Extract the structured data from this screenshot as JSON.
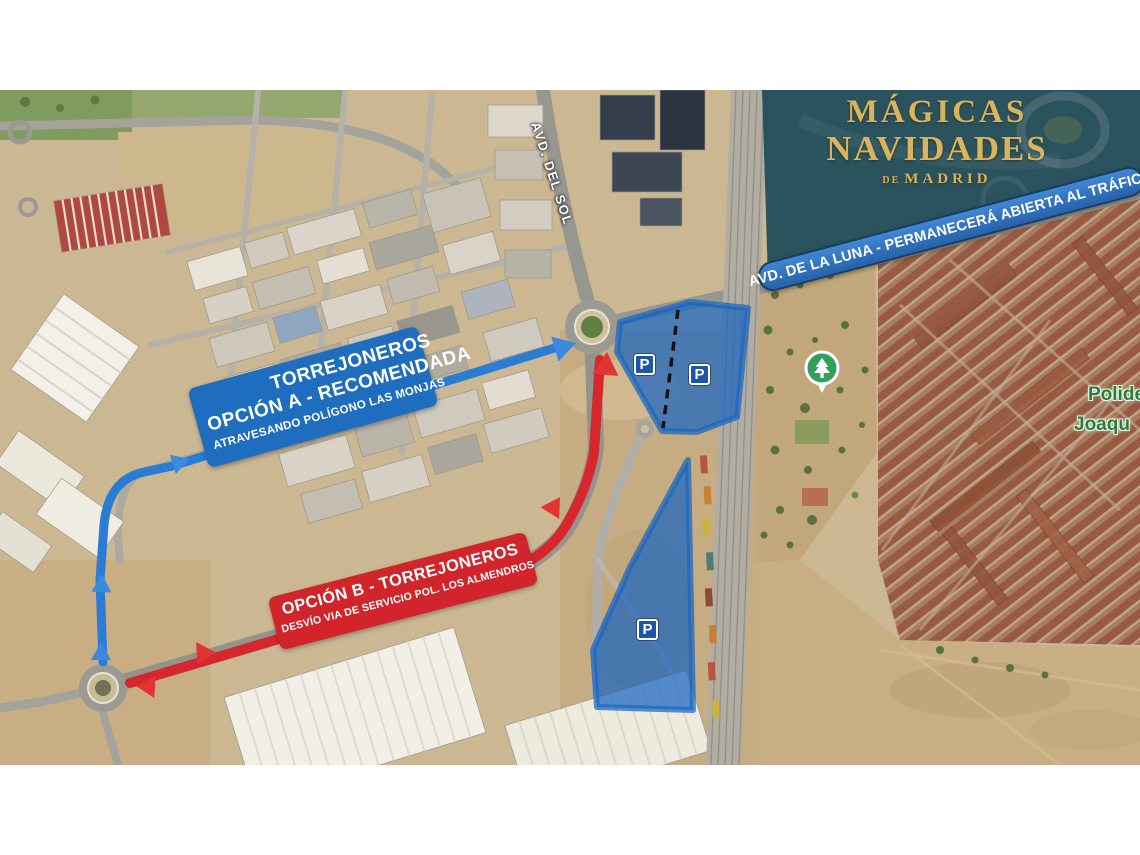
{
  "logo": {
    "title_line1": "MÁGICAS",
    "title_line2": "NAVIDADES",
    "subtitle_de": "DE",
    "subtitle_madrid": "MADRID"
  },
  "overlay_banner": {
    "text": "AVD. DE LA LUNA - PERMANECERÁ ABIERTA AL TRÁFICO"
  },
  "route_option_a": {
    "line1": "TORREJONEROS",
    "line2": "OPCIÓN A -  RECOMENDADA",
    "line3": "ATRAVESANDO POLÍGONO LAS MONJAS"
  },
  "route_option_b": {
    "line1": "OPCIÓN B - TORREJONEROS",
    "line2": "DESVÍO VIA DE SERVICIO POL. LOS ALMENDROS"
  },
  "street_labels": {
    "avd_del_sol": "AVD. DEL SOL"
  },
  "map_labels": {
    "place_line1": "Polide",
    "place_line2": "Joaqu"
  },
  "parking_badges": [
    {
      "letter": "P"
    },
    {
      "letter": "P"
    },
    {
      "letter": "P"
    }
  ],
  "colors": {
    "route_a_blue": "#2b7cd3",
    "route_b_red": "#d7262c",
    "parking_fill": "rgba(25,101,192,0.72)",
    "venue_overlay": "#1d4a59",
    "logo_gold": "#d9b45c",
    "label_a_bg": "#1e6dbf",
    "label_b_bg": "#d2252b"
  }
}
